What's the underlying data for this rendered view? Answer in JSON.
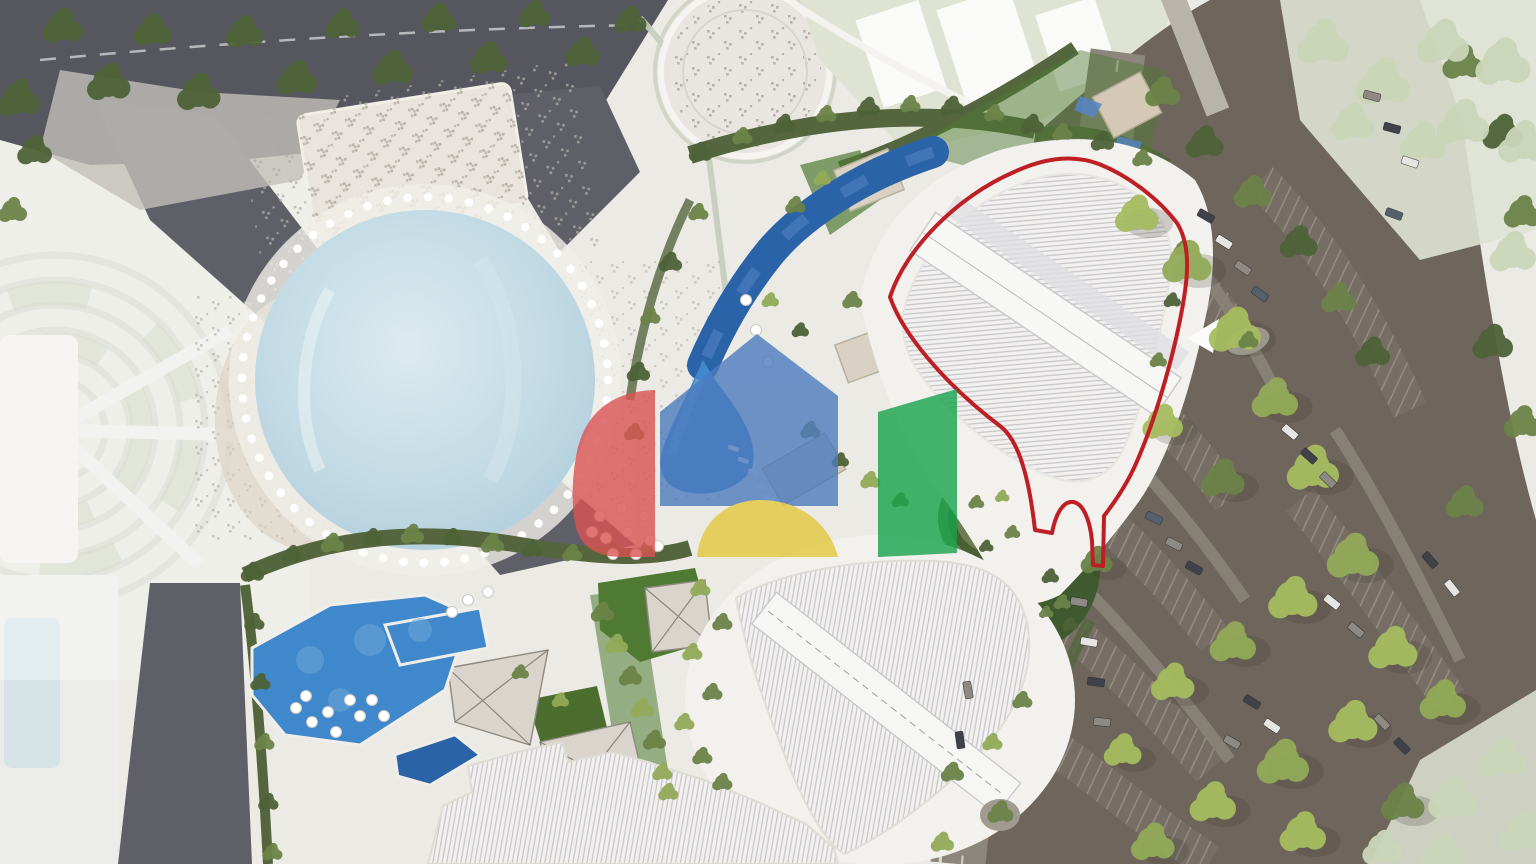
{
  "meta": {
    "title": "Aerial masterplan rendering of a mixed-use resort development",
    "type": "architectural-site-plan-render",
    "visible_text": "none"
  },
  "scene": {
    "description": "Top-down architectural rendering: white leisure plaza with large circular pool, lounge deck and round event plaza; winding dark-blue lap pool; landscaped amenity deck with bright blue pools, lawns and pavilions; three white ridged-roof buildings; one parcel highlighted with a red outline including a small oval island; curved tree-lined parking lot on the right; dark access roads top-left and bottom-left; faded context areas on the far left and corners; semi-transparent four-colour house logo watermark in the centre.",
    "highlight": {
      "name": "highlighted-parcel",
      "outline_color": "#BE1F24"
    },
    "watermark": {
      "name": "four-color-house-logo",
      "opacity": 0.8,
      "shapes": [
        {
          "name": "red-swoosh",
          "color": "#D95252"
        },
        {
          "name": "blue-house",
          "color": "#4C7BBE"
        },
        {
          "name": "yellow-fan",
          "color": "#E3C83C"
        },
        {
          "name": "green-panel",
          "color": "#17A24B"
        }
      ]
    },
    "regions": [
      "top-left-road",
      "left-faded-context",
      "leisure-plaza",
      "main-circular-pool",
      "round-event-plaza",
      "canopy-courts-area",
      "lap-pool",
      "highlighted-parcel-building",
      "teardrop-building",
      "bottom-ridged-building",
      "amenity-deck-pools",
      "lawns",
      "round-garden-courtyard",
      "green-island",
      "access-road",
      "parking-lot",
      "washed-out-corners",
      "watermark-logo"
    ]
  },
  "palette": {
    "bg_plaza": "#ECEAE5",
    "road_dark": "#56565E",
    "road_dark2": "#5F5F68",
    "road_light": "#8D867C",
    "asphalt": "#6E665C",
    "asphalt_light": "#7A7268",
    "stall_bg": "#776F65",
    "stall_line": "#968F83",
    "faded_ground": "#E7E8E1",
    "faded_arc": "#D8D8D0",
    "faded_green": "#C8CEB6",
    "pale_zone": "#DFE3D4",
    "tree_pale": "#CBD6B9",
    "white_struct": "#F3F1ED",
    "roof_base": "#F2F1EF",
    "roof_line": "#C7C7CB",
    "pool_big": "#C2DAE4",
    "pool_deep": "#2B63A8",
    "pool_deep_hi": "#5585C5",
    "pool_bright": "#3E88CB",
    "lawn": "#4E7A33",
    "lawn_dark": "#426724",
    "hedge": "#55663E",
    "tree_dark": "#4E6238",
    "tree_mid": "#6C8348",
    "tree_light": "#93AA58",
    "tree_yellow": "#A6BC5F",
    "paved": "#D9D5CC",
    "paved_line": "#B7B1A7",
    "sand": "#D9CEC0",
    "highlight_red": "#BE1F24",
    "wm_red": "#D95252",
    "wm_blue": "#4C7BBE",
    "wm_yellow": "#E3C83C",
    "wm_green": "#17A24B",
    "car_dark": "#3F4248",
    "car_gray": "#8E8A83",
    "car_white": "#E6E5E2",
    "car_blue": "#55606E",
    "arrow_white": "#FBFBF9"
  }
}
